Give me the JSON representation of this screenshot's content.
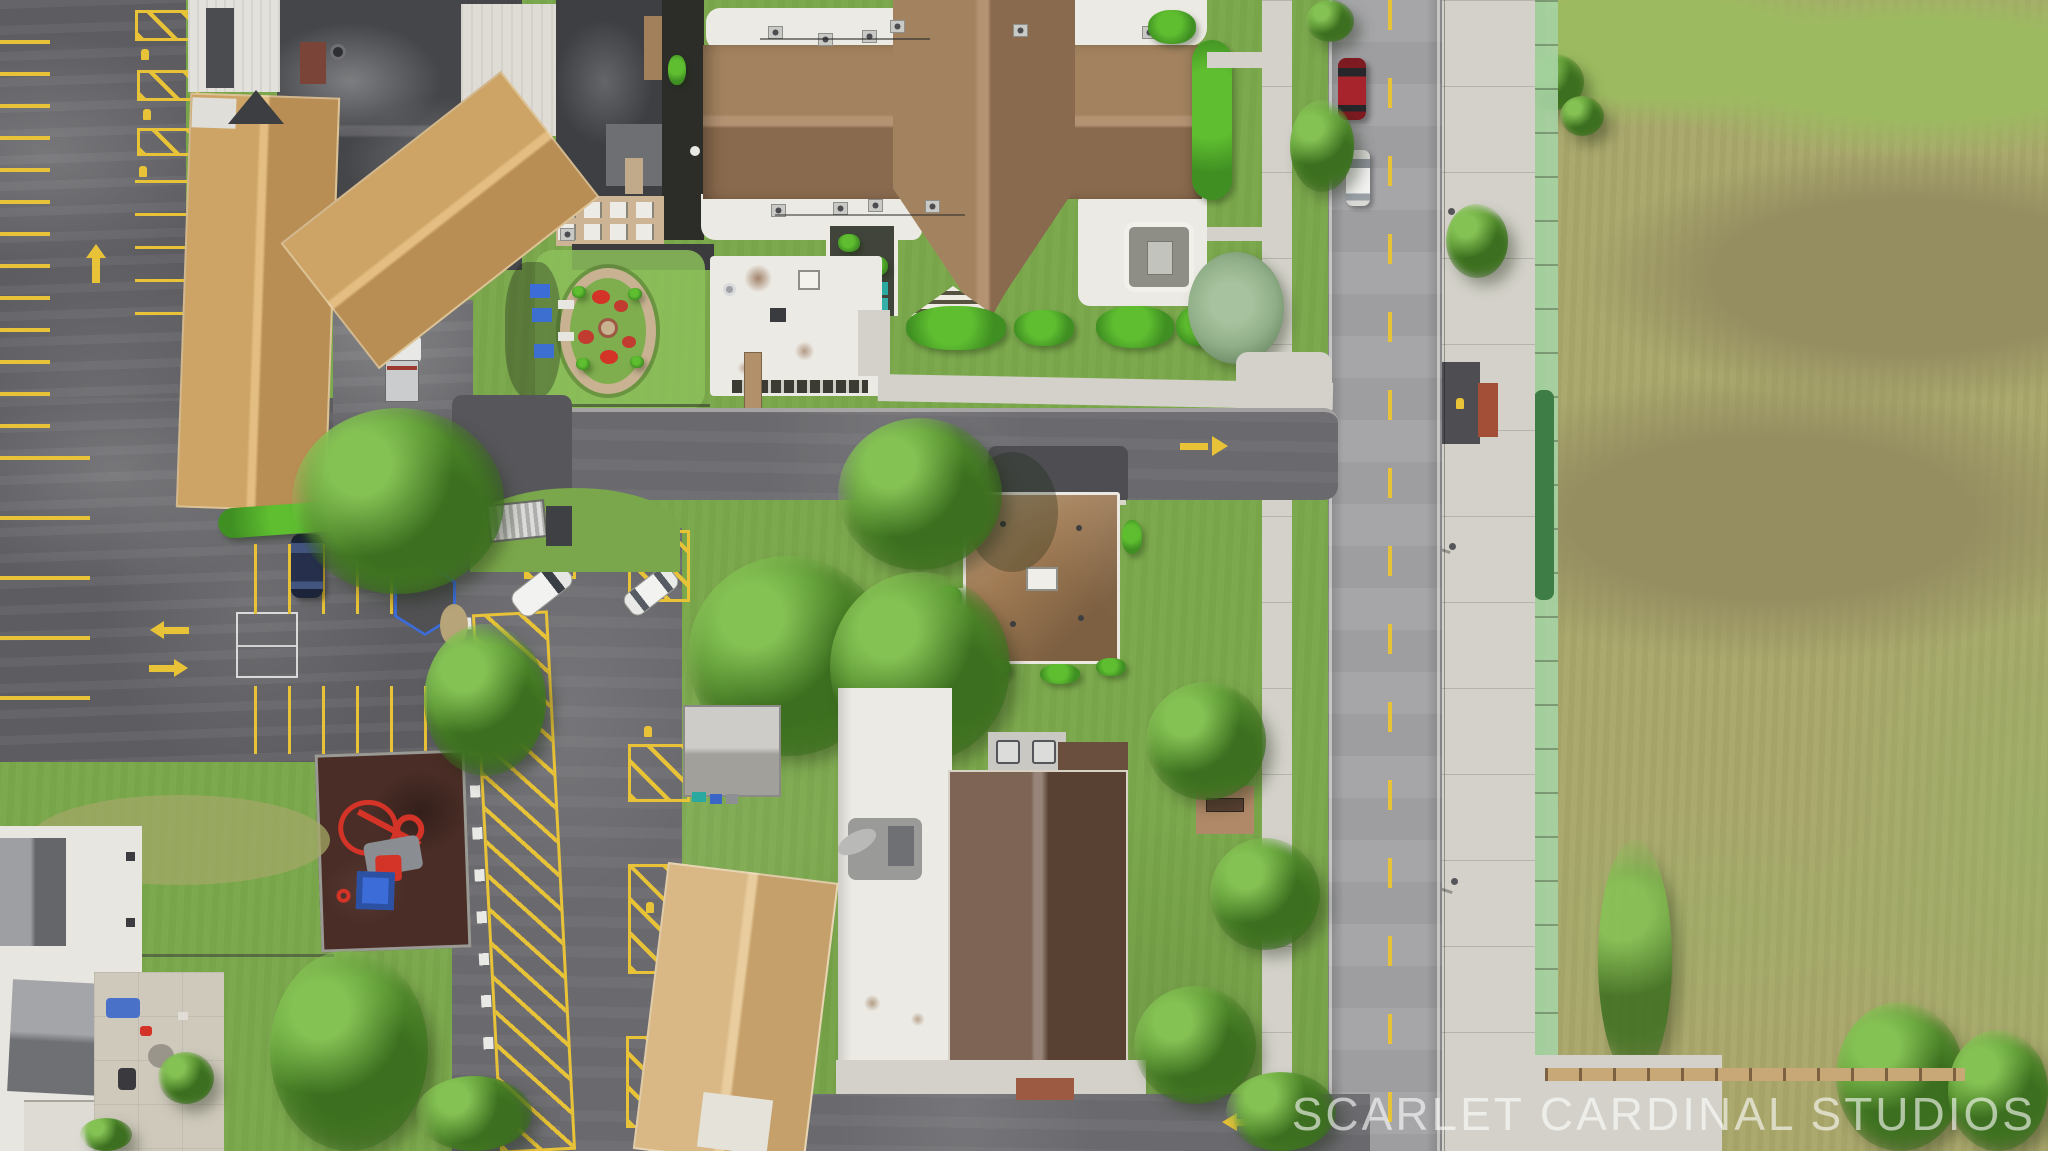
{
  "meta": {
    "type": "aerial-drone-photograph",
    "description": "Top-down aerial view of a suburban block: striped asphalt parking lots and tan-roof school buildings on the left, a church campus with a brown cross-gable roof at top center, a hip-roof house on a green lot at center, small out-buildings and a playground at the bottom, a two-lane road with a green silt fence and a large olive grass field on the right.",
    "width_px": 2048,
    "height_px": 1151
  },
  "watermark": {
    "text": "SCARLET CARDINAL STUDIOS",
    "color_hex": "#ffffff",
    "opacity": 0.6
  },
  "palette": {
    "grass": "#7aa74b",
    "grass_bright": "#8cc05a",
    "grass_dry": "#a3a866",
    "field": "#a9a76b",
    "field_dark": "#958e61",
    "field_bright": "#9cbb60",
    "asphalt": "#5d5d61",
    "asphalt_mid": "#6a6a6e",
    "asphalt_light": "#77777b",
    "asphalt_dark": "#4e4e52",
    "concrete": "#d3d1c9",
    "road": "#a3a3a6",
    "line_yellow": "#e9c337",
    "line_white": "#e8e8e6",
    "roof_tan": "#cda465",
    "roof_tan_dark": "#b98e55",
    "roof_brown": "#a3835f",
    "roof_brown_dark": "#8a6a4e",
    "roof_ridge": "#b39372",
    "roof_house": "#a07b54",
    "roof_dark_brown": "#6b4f3e",
    "roof_white": "#eceae4",
    "roof_dark": "#45464a",
    "roof_gray": "#b8b6b0",
    "hedge": "#3f8f22",
    "hedge_hi": "#5fbe30",
    "tree": "#58962f",
    "tree_hi": "#85c254",
    "tree_dark": "#3c6f1f",
    "spruce": "#8fae87",
    "play_surface": "#4a2d26",
    "play_red": "#d43327",
    "canopy_blue": "#3c6cd8",
    "car_red": "#a8242c",
    "car_navy": "#26304c",
    "vehicle_white": "#f2f2f1",
    "fence_green": "#a7d3a4",
    "fence_green_dark": "#3f7d46",
    "brick": "#9c5a42",
    "wood": "#c9a878"
  },
  "scene": {
    "regions": [
      {
        "name": "parking-lot-west",
        "label": "striped asphalt parking lot with handicap hatching and lane arrows"
      },
      {
        "name": "school-buildings",
        "label": "flat dark roofs and tan shingle gable roofs"
      },
      {
        "name": "circular-garden",
        "label": "round flower bed with red annuals"
      },
      {
        "name": "church-campus",
        "label": "brown cross-gable shingle roof with white flat-roof wings and rooftop HVAC"
      },
      {
        "name": "center-house",
        "label": "brown hip-roof house with white cupola on a lawn"
      },
      {
        "name": "playground",
        "label": "rubber-mulch playground with red equipment and blue canopy"
      },
      {
        "name": "south-buildings",
        "label": "gray shed, white flat-roof building, dark brown gable building"
      },
      {
        "name": "road",
        "label": "two-lane asphalt road with dashed yellow center line and two cars"
      },
      {
        "name": "field",
        "label": "large olive-green grass field behind a green construction silt fence"
      }
    ]
  }
}
